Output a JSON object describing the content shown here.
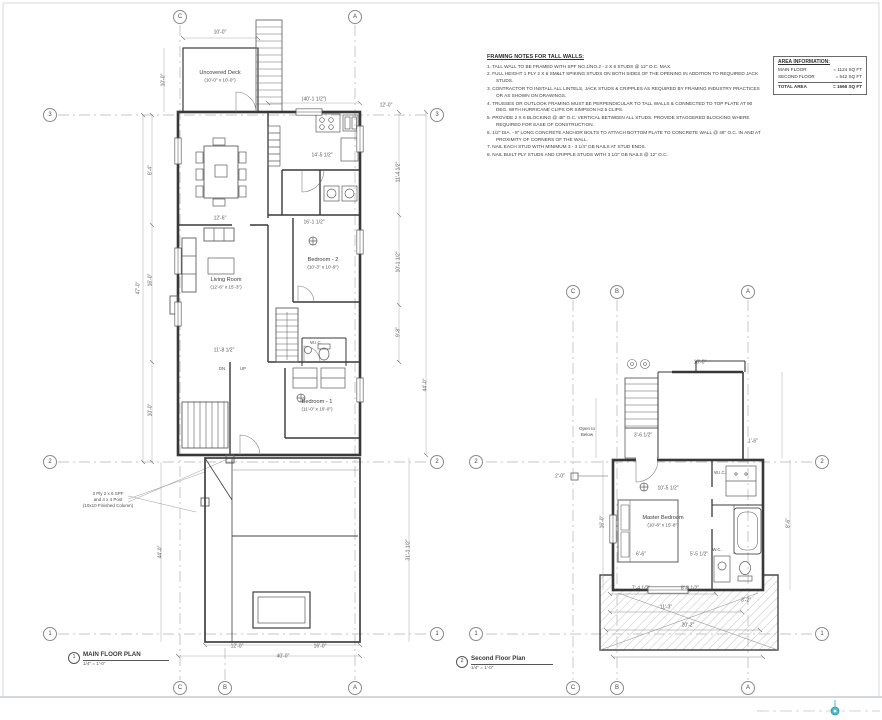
{
  "drawing": {
    "framing_notes": {
      "title": "FRAMING NOTES FOR TALL WALLS:",
      "items": [
        "1.  TALL WALL TO BE FRAMED WITH SPF NO.1/NO.2 - 2 X 6 STUDS @ 12\" O.C. MAX.",
        "2.  FULL HEIGHT 1 PLY 2 X 6 SM&LT SPIKING STUDS ON BOTH SIDES OF THE OPENING IN ADDITION TO REQUIRED JACK STUDS.",
        "3.  CONTRACTOR TO INSTALL ALL LINTELS, JACK STUDS & CRIPPLES AS REQUIRED BY FRAMING INDUSTRY PRACTICES OR AS SHOWN ON DRAWINGS.",
        "4.  TRUSSES OR OUTLOOK FRAMING MUST BE PERPENDICULAR TO TALL WALLS & CONNECTED TO TOP PLATE AT 90 DEG. WITH HURRICANE CLIPS OR SIMPSON H2.5 CLIPS.",
        "5.  PROVIDE 2 X 6 BLOCKING @ 48\" O.C. VERTICAL BETWEEN ALL STUDS. PROVIDE STAGGERED BLOCKING WHERE REQUIRED FOR EASE OF CONSTRUCTION.",
        "6.  1/2\" DIA. - 8\" LONG CONCRETE ANCHOR BOLTS TO ATTACH BOTTOM PLATE TO CONCRETE WALL @ 48\" O.C. IN AND AT PROXIMITY OF CORNERS OF THE WALL.",
        "7.  NAIL EACH STUD WITH MINIMUM 3 - 3 1/4\" GB NAILS AT STUD ENDS.",
        "8.  NAIL BUILT PLY STUDS AND CRIPPLE STUDS WITH 3 1/2\" GB NAILS @ 12\" O.C."
      ]
    },
    "area_info": {
      "title": "AREA INFORMATION:",
      "rows": [
        {
          "label": "MAIN FLOOR",
          "value": "= 1124 SQ FT"
        },
        {
          "label": "SECOND FLOOR",
          "value": "= 542 SQ FT"
        },
        {
          "label": "TOTAL AREA",
          "value": "= 1666 SQ FT"
        }
      ]
    },
    "grid": {
      "a": "A",
      "b": "B",
      "c": "C",
      "n1": "1",
      "n2": "2",
      "n3": "3"
    },
    "main_plan": {
      "callout": "1",
      "title": "MAIN FLOOR PLAN",
      "scale": "1/4\" = 1'-0\"",
      "labels": {
        "deck": "Uncovered Deck",
        "deck_dims": "(10'-0\" x 10'-0\")",
        "living": "Living Room",
        "living_dims": "(12'-6\" x 15'-3\")",
        "bedroom2": "Bedroom - 2",
        "bedroom2_dims": "(10'-3\" x 10'-9\")",
        "bedroom1": "Bedroom - 1",
        "bedroom1_dims": "(11'-0\" x 10'-0\")",
        "dn": "DN",
        "up": "UP",
        "wic": "W.I.C.",
        "post_note_1": "3 Ply 2 x 6 SPF",
        "post_note_2": "and 4 x 4 Post",
        "post_note_3": "(10x10 Finished Column)"
      },
      "dims": [
        "10'-0\"",
        "10'-0\"",
        "(40'-1 1/2\")",
        "12'-0\"",
        "8'-4\"",
        "16'-0\"",
        "10'-0\"",
        "47'-0\"",
        "11'-4 1/2\"",
        "10'-1 1/2\"",
        "9'-8\"",
        "44'-0\"",
        "31'-1 1/2\"",
        "44'-0\"",
        "14'-5 1/2\"",
        "16'-1 1/2\"",
        "11'-8 1/2\"",
        "12'-6\"",
        "12'-0\"",
        "16'-0\"",
        "40'-0\""
      ]
    },
    "second_plan": {
      "callout": "2",
      "title": "Second Floor Plan",
      "scale": "1/4\" = 1'-0\"",
      "labels": {
        "master": "Master Bedroom",
        "master_dims": "(10'-8\" x 15'-8\")",
        "open_below_1": "Open to",
        "open_below_2": "Below",
        "wic": "W.I.C.",
        "wc": "W.C."
      },
      "dims": [
        "10'-0\"",
        "3'-6 1/2\"",
        "1'-6\"",
        "10'-5 1/2\"",
        "16'-0\"",
        "6'-6\"",
        "5'-5 1/2\"",
        "7'-4 1/2\"",
        "8'-8 1/2\"",
        "11'-3\"",
        "20'-2\"",
        "3'-2\"",
        "8'-6\"",
        "2'-0\""
      ]
    },
    "colors": {
      "accent_pin": "#4db9c9",
      "ink": "#383838"
    }
  }
}
